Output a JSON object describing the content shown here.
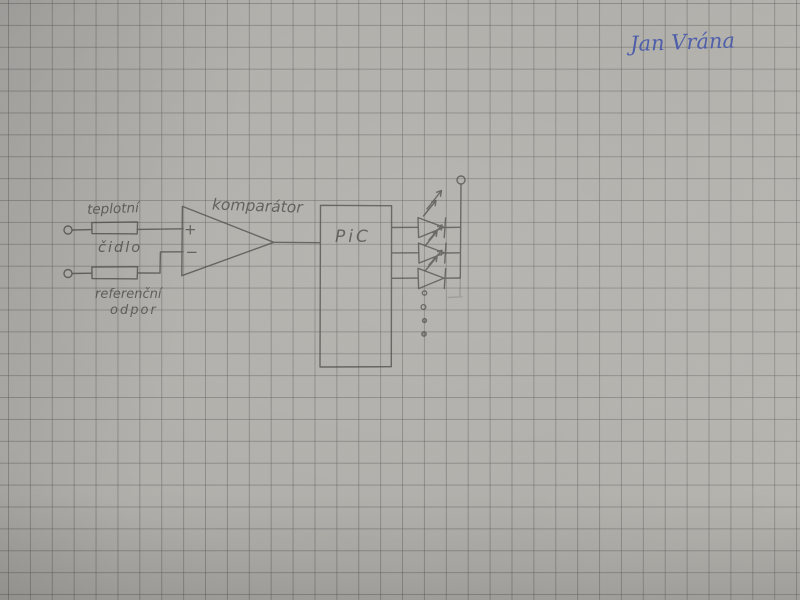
{
  "photo": {
    "description": "hand-drawn electronic schematic sketched in pencil on gray squared graph paper",
    "paper_color": "#b1afaa",
    "grid_color": "#5c5c5a",
    "pencil_color": "#4b4945",
    "ink_color": "#4254a8"
  },
  "signature": {
    "text": "Jan Vrána"
  },
  "schematic": {
    "labels": {
      "sensor_line1": "teplotní",
      "sensor_line2": "čidlo",
      "reference_line1": "referenční",
      "reference_line2": "odpor",
      "comparator": "komparátor",
      "comparator_plus": "+",
      "comparator_minus": "−",
      "mcu": "PiC"
    },
    "counts": {
      "input_terminals": 2,
      "resistors": 2,
      "leds": 3,
      "continuation_dots": 4
    }
  }
}
